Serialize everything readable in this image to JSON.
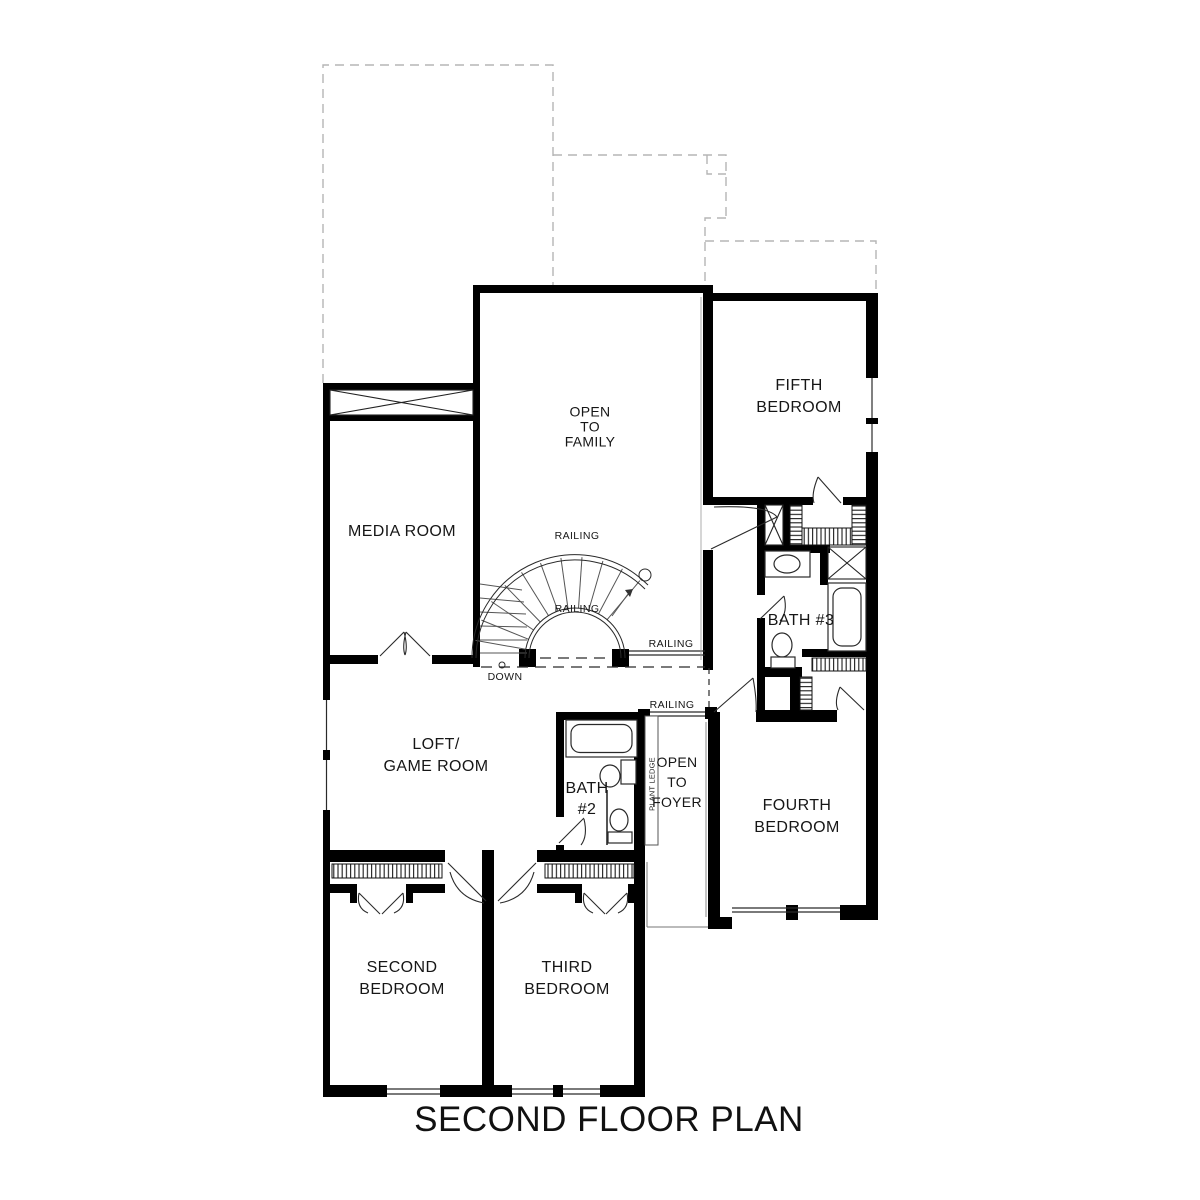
{
  "page": {
    "title": "SECOND FLOOR PLAN"
  },
  "colors": {
    "wall": "#000000",
    "thin_line": "#2a2a2a",
    "roof_dash": "#b5b5b5"
  },
  "labels": {
    "media_room": [
      "MEDIA ROOM"
    ],
    "open_to_family": [
      "OPEN",
      "TO",
      "FAMILY"
    ],
    "fifth_bedroom": [
      "FIFTH",
      "BEDROOM"
    ],
    "bath_3": [
      "BATH #3"
    ],
    "loft_game_room": [
      "LOFT/",
      "GAME ROOM"
    ],
    "bath_2": [
      "BATH",
      "#2"
    ],
    "open_to_foyer": [
      "OPEN",
      "TO",
      "FOYER"
    ],
    "fourth_bedroom": [
      "FOURTH",
      "BEDROOM"
    ],
    "second_bedroom": [
      "SECOND",
      "BEDROOM"
    ],
    "third_bedroom": [
      "THIRD",
      "BEDROOM"
    ]
  },
  "annotations": {
    "railing": "RAILING",
    "down": "DOWN",
    "plant_ledge": "PLANT LEDGE"
  }
}
